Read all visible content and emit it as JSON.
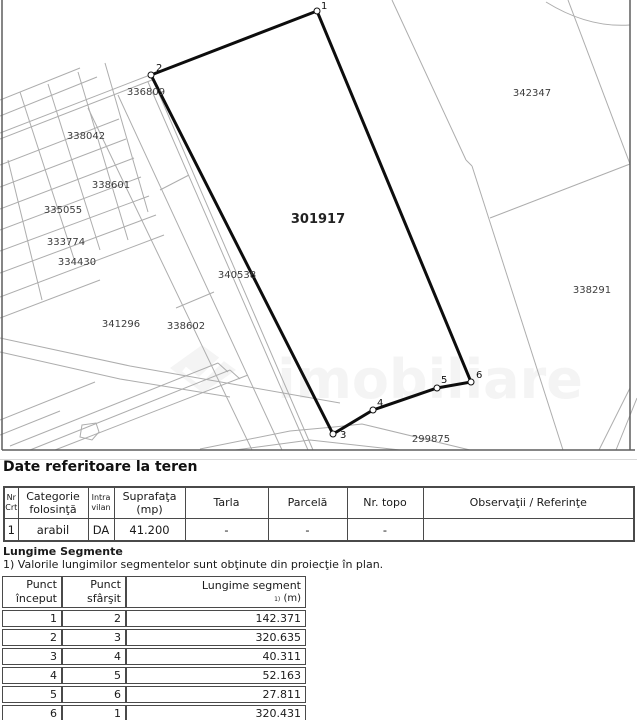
{
  "terrain": {
    "heading": "Date referitoare la teren",
    "headers": [
      {
        "l1": "Nr",
        "l2": "Crt"
      },
      {
        "l1": "Categorie",
        "l2": "folosinţă"
      },
      {
        "l1": "Intra",
        "l2": "vilan"
      },
      {
        "l1": "Suprafaţa",
        "l2": "(mp)"
      },
      {
        "l1": "Tarla",
        "l2": ""
      },
      {
        "l1": "Parcelă",
        "l2": ""
      },
      {
        "l1": "Nr. topo",
        "l2": ""
      },
      {
        "l1": "Observaţii / Referinţe",
        "l2": ""
      }
    ],
    "rows": [
      [
        "1",
        "arabil",
        "DA",
        "41.200",
        "-",
        "-",
        "-",
        ""
      ]
    ]
  },
  "segments": {
    "title": "Lungime Segmente",
    "note": "1) Valorile lungimilor segmentelor sunt obţinute din proiecţie în plan.",
    "headers": {
      "start_l1": "Punct",
      "start_l2": "început",
      "end_l1": "Punct",
      "end_l2": "sfârşit",
      "len_l1": "Lungime segment",
      "len_sup": "1)",
      "len_unit": "(m)"
    },
    "rows": [
      [
        "1",
        "2",
        "142.371"
      ],
      [
        "2",
        "3",
        "320.635"
      ],
      [
        "3",
        "4",
        "40.311"
      ],
      [
        "4",
        "5",
        "52.163"
      ],
      [
        "5",
        "6",
        "27.811"
      ],
      [
        "6",
        "1",
        "320.431"
      ]
    ]
  },
  "map": {
    "colors": {
      "parcel_line": "#adadad",
      "frame_line": "#5f5f5f",
      "polygon": "#0d0d0d",
      "label": "#3c3c3c",
      "bold_label": "#222222",
      "vertex": "#111111",
      "watermark": "#8a8a8a"
    },
    "frame_lines": [
      [
        2,
        0,
        2,
        450
      ],
      [
        2,
        450,
        635,
        450
      ],
      [
        630,
        0,
        630,
        450
      ]
    ],
    "gray_lines": [
      [
        392,
        0,
        466,
        160
      ],
      [
        466,
        160,
        472,
        166
      ],
      [
        472,
        166,
        563,
        450
      ],
      [
        490,
        218,
        630,
        164
      ],
      [
        568,
        0,
        630,
        164
      ],
      [
        630,
        388,
        599,
        450
      ],
      [
        637,
        398,
        616,
        450
      ],
      [
        88,
        108,
        252,
        450
      ],
      [
        118,
        95,
        282,
        450
      ],
      [
        148,
        82,
        308,
        450
      ],
      [
        153,
        80,
        313,
        450
      ],
      [
        0,
        100,
        80,
        68
      ],
      [
        0,
        116,
        97,
        77
      ],
      [
        0,
        133,
        150,
        75
      ],
      [
        0,
        139,
        152,
        80
      ],
      [
        0,
        165,
        119,
        119
      ],
      [
        0,
        187,
        126,
        139
      ],
      [
        0,
        209,
        134,
        158
      ],
      [
        0,
        230,
        141,
        177
      ],
      [
        0,
        251,
        149,
        196
      ],
      [
        0,
        273,
        156,
        215
      ],
      [
        0,
        297,
        164,
        235
      ],
      [
        0,
        318,
        100,
        280
      ],
      [
        20,
        92,
        75,
        262
      ],
      [
        48,
        84,
        100,
        250
      ],
      [
        78,
        72,
        128,
        240
      ],
      [
        105,
        63,
        148,
        212
      ],
      [
        8,
        160,
        42,
        300
      ],
      [
        160,
        190,
        189,
        175
      ],
      [
        176,
        308,
        214,
        292
      ],
      [
        10,
        446,
        218,
        363
      ],
      [
        30,
        450,
        230,
        370
      ],
      [
        0,
        420,
        95,
        382
      ],
      [
        55,
        450,
        248,
        375
      ],
      [
        0,
        435,
        60,
        411
      ],
      [
        218,
        363,
        228,
        372
      ],
      [
        230,
        370,
        240,
        379
      ]
    ],
    "gray_paths": [
      "M546,2 Q588,28 630,25",
      "M200,449 L290,431 L334,427 L362,424 L470,450",
      "M235,450 L310,440 L400,450",
      "M0,338 L130,366 L340,403",
      "M0,352 L120,379 L230,397",
      "M82,425 L96,423 L99,432 L92,440 L80,437 Z"
    ],
    "polygon": {
      "points": [
        [
          317,
          11
        ],
        [
          151,
          75
        ],
        [
          333,
          434
        ],
        [
          373,
          410
        ],
        [
          437,
          388
        ],
        [
          471,
          382
        ]
      ]
    },
    "vertices": [
      {
        "n": "1",
        "cx": 317,
        "cy": 11,
        "tx": 321,
        "ty": 9
      },
      {
        "n": "2",
        "cx": 151,
        "cy": 75,
        "tx": 156,
        "ty": 71
      },
      {
        "n": "3",
        "cx": 333,
        "cy": 434,
        "tx": 340,
        "ty": 438
      },
      {
        "n": "4",
        "cx": 373,
        "cy": 410,
        "tx": 377,
        "ty": 406
      },
      {
        "n": "5",
        "cx": 437,
        "cy": 388,
        "tx": 441,
        "ty": 383
      },
      {
        "n": "6",
        "cx": 471,
        "cy": 382,
        "tx": 476,
        "ty": 378
      }
    ],
    "labels": [
      {
        "t": "336809",
        "x": 146,
        "y": 95
      },
      {
        "t": "338042",
        "x": 86,
        "y": 139
      },
      {
        "t": "338601",
        "x": 111,
        "y": 188
      },
      {
        "t": "335055",
        "x": 63,
        "y": 213
      },
      {
        "t": "333774",
        "x": 66,
        "y": 245
      },
      {
        "t": "334430",
        "x": 77,
        "y": 265
      },
      {
        "t": "341296",
        "x": 121,
        "y": 327
      },
      {
        "t": "338602",
        "x": 186,
        "y": 329
      },
      {
        "t": "340538",
        "x": 237,
        "y": 278
      },
      {
        "t": "299875",
        "x": 431,
        "y": 442
      },
      {
        "t": "342347",
        "x": 532,
        "y": 96
      },
      {
        "t": "338291",
        "x": 592,
        "y": 293
      },
      {
        "t": "301917",
        "x": 318,
        "y": 223,
        "bold": true,
        "size": 13
      }
    ],
    "watermark": {
      "text": "imobiliare",
      "text_x": 430,
      "text_y": 398,
      "font_size": 54,
      "opacity": 0.09,
      "logo_points": "170,368 202,345 236,370 203,393",
      "check_path": "M184,369 L199,381 L224,357"
    }
  }
}
